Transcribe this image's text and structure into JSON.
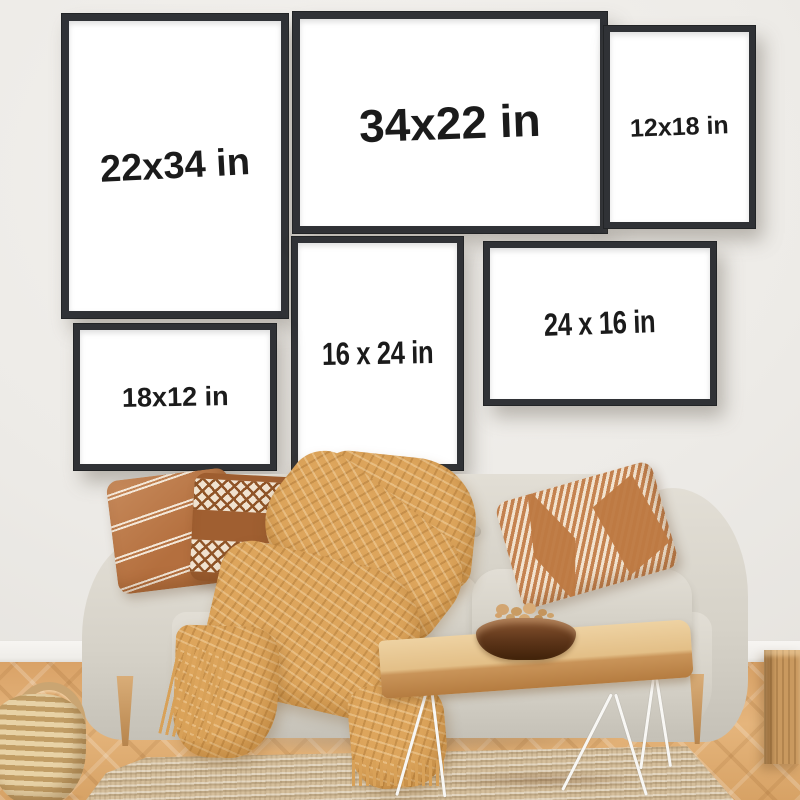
{
  "frames": [
    {
      "id": "frame-22x34",
      "label": "22x34 in",
      "orientation": "portrait"
    },
    {
      "id": "frame-34x22",
      "label": "34x22 in",
      "orientation": "landscape"
    },
    {
      "id": "frame-12x18",
      "label": "12x18 in",
      "orientation": "portrait"
    },
    {
      "id": "frame-16x24",
      "label": "16 x 24 in",
      "orientation": "portrait"
    },
    {
      "id": "frame-24x16",
      "label": "24 x 16 in",
      "orientation": "landscape"
    },
    {
      "id": "frame-18x12",
      "label": "18x12 in",
      "orientation": "landscape"
    }
  ],
  "palette": {
    "wall": "#edeae6",
    "frame_border": "#303236",
    "frame_canvas": "#ffffff",
    "label_text": "#1b1b1b",
    "sofa_fabric": "#d6d2c8",
    "pillow_caramel": "#b46f3e",
    "pillow_brown": "#a05f31",
    "blanket_mustard": "#dda55c",
    "wood_light": "#e3bf87",
    "floor_oak": "#dca770",
    "rug_jute": "#d4be9b",
    "bowl_walnut": "#5d3519"
  }
}
